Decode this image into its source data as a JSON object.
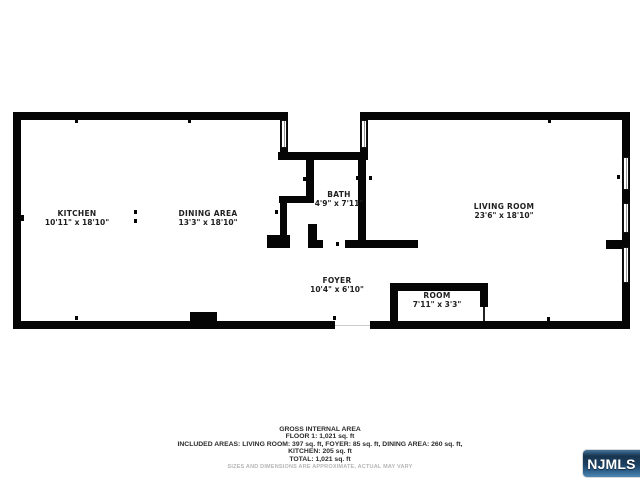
{
  "rooms": {
    "kitchen": {
      "name": "KITCHEN",
      "dims": "10'11\" x 18'10\""
    },
    "dining": {
      "name": "DINING AREA",
      "dims": "13'3\" x 18'10\""
    },
    "bath": {
      "name": "BATH",
      "dims": "4'9\" x 7'11\""
    },
    "living": {
      "name": "LIVING ROOM",
      "dims": "23'6\" x 18'10\""
    },
    "foyer": {
      "name": "FOYER",
      "dims": "10'4\" x 6'10\""
    },
    "room": {
      "name": "ROOM",
      "dims": "7'11\" x 3'3\""
    }
  },
  "summary": {
    "title": "GROSS INTERNAL AREA",
    "floor_line": "FLOOR 1: 1,021 sq. ft",
    "included_line": "INCLUDED AREAS: LIVING ROOM: 397 sq. ft, FOYER: 85 sq. ft, DINING AREA: 260 sq. ft,",
    "kitchen_line": "KITCHEN: 205 sq. ft",
    "total_line": "TOTAL: 1,021 sq. ft",
    "disclaimer": "SIZES AND DIMENSIONS ARE APPROXIMATE, ACTUAL MAY VARY"
  },
  "logo": {
    "text": "NJMLS",
    "gradient_top": "#17344f",
    "gradient_bottom": "#4d87b4",
    "text_color": "#ffffff"
  },
  "colors": {
    "wall": "#050505",
    "background": "#ffffff",
    "label_text": "#1f1f1f",
    "summary_text": "#2b2b2b",
    "disclaimer_text": "#b5b5b5"
  }
}
